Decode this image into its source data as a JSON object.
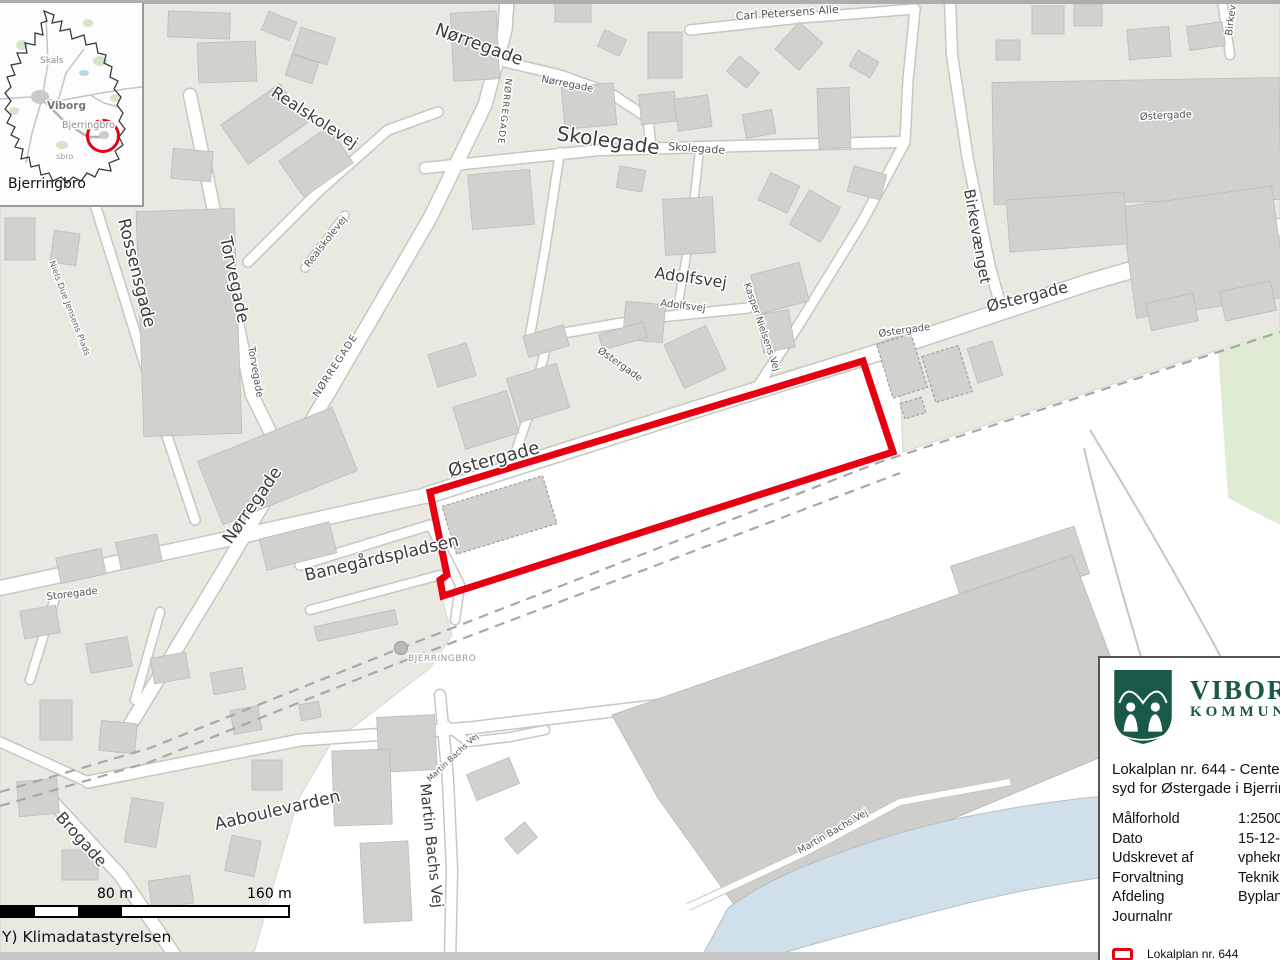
{
  "attribution": "Y) Klimadatastyrelsen",
  "scale_bar": {
    "label_mid": "80 m",
    "label_end": "160 m"
  },
  "inset": {
    "caption": "Bjerringbro",
    "labels": [
      {
        "text": "Skals",
        "x": 40,
        "y": 60,
        "rot": 0,
        "size": 9,
        "color": "#8e8e8e"
      },
      {
        "text": "Viborg",
        "x": 47,
        "y": 106,
        "rot": 0,
        "size": 10.5,
        "color": "#767676",
        "weight": "bold"
      },
      {
        "text": "Bjerringbro",
        "x": 62,
        "y": 125,
        "rot": 0,
        "size": 9.5,
        "color": "#8e8e8e"
      },
      {
        "text": "sbro",
        "x": 56,
        "y": 156,
        "rot": 0,
        "size": 8,
        "color": "#9a9a9a"
      }
    ]
  },
  "map": {
    "labels": [
      {
        "text": "Nørregade",
        "x": 434,
        "y": 34,
        "rot": 20,
        "size": 17.5
      },
      {
        "text": "NØRREGADE",
        "x": 506,
        "y": 78,
        "rot": 97,
        "size": 9,
        "color": "#555555",
        "ls": 1
      },
      {
        "text": "Nørregade",
        "x": 541,
        "y": 82,
        "rot": 11,
        "size": 10,
        "color": "#555555"
      },
      {
        "text": "Carl Petersens Alle",
        "x": 736,
        "y": 20,
        "rot": -4,
        "size": 11,
        "color": "#555555"
      },
      {
        "text": "Skolegade",
        "x": 556,
        "y": 140,
        "rot": 8,
        "size": 20
      },
      {
        "text": "Skolegade",
        "x": 668,
        "y": 150,
        "rot": 4,
        "size": 11,
        "color": "#555555"
      },
      {
        "text": "Realskolevej",
        "x": 270,
        "y": 95,
        "rot": 33,
        "size": 16
      },
      {
        "text": "Realskolevej",
        "x": 309,
        "y": 268,
        "rot": -52,
        "size": 10,
        "color": "#555555"
      },
      {
        "text": "Rossensgade",
        "x": 118,
        "y": 220,
        "rot": 76,
        "size": 17
      },
      {
        "text": "Torvegade",
        "x": 220,
        "y": 238,
        "rot": 78,
        "size": 17
      },
      {
        "text": "Torvegade",
        "x": 248,
        "y": 347,
        "rot": 80,
        "size": 10,
        "color": "#555555"
      },
      {
        "text": "NØRREGADE",
        "x": 318,
        "y": 398,
        "rot": -57,
        "size": 10,
        "color": "#555555",
        "ls": 1
      },
      {
        "text": "Niels Due Jensens Plads",
        "x": 49,
        "y": 262,
        "rot": 69,
        "size": 8.5,
        "color": "#666666"
      },
      {
        "text": "Adolfsvej",
        "x": 654,
        "y": 278,
        "rot": 8,
        "size": 16
      },
      {
        "text": "Adolfsvej",
        "x": 660,
        "y": 306,
        "rot": 7,
        "size": 10,
        "color": "#555555"
      },
      {
        "text": "Kasper Nielsens Vej",
        "x": 744,
        "y": 284,
        "rot": 71,
        "size": 9.5,
        "color": "#555555"
      },
      {
        "text": "Birkevænget",
        "x": 964,
        "y": 190,
        "rot": 80,
        "size": 15
      },
      {
        "text": "Birkev",
        "x": 1232,
        "y": 36,
        "rot": -83,
        "size": 10,
        "color": "#555555"
      },
      {
        "text": "Østergade",
        "x": 879,
        "y": 337,
        "rot": -8,
        "size": 10,
        "color": "#555555"
      },
      {
        "text": "Østergade",
        "x": 988,
        "y": 312,
        "rot": -14,
        "size": 16
      },
      {
        "text": "Østergade",
        "x": 1140,
        "y": 120,
        "rot": -3,
        "size": 10,
        "color": "#555555"
      },
      {
        "text": "Østergade",
        "x": 450,
        "y": 477,
        "rot": -15,
        "size": 18
      },
      {
        "text": "Østergade",
        "x": 597,
        "y": 352,
        "rot": 35,
        "size": 10,
        "color": "#555555"
      },
      {
        "text": "Banegårdspladsen",
        "x": 306,
        "y": 581,
        "rot": -13,
        "size": 17
      },
      {
        "text": "Nørregade",
        "x": 231,
        "y": 545,
        "rot": -55,
        "size": 17
      },
      {
        "text": "Storegade",
        "x": 47,
        "y": 600,
        "rot": -7,
        "size": 10,
        "color": "#555555"
      },
      {
        "text": "BJERRINGBRO",
        "x": 408,
        "y": 661,
        "rot": 0,
        "size": 9,
        "color": "#9a9a9a",
        "ls": 0.5
      },
      {
        "text": "Aaboulevarden",
        "x": 216,
        "y": 830,
        "rot": -13,
        "size": 17
      },
      {
        "text": "Brogade",
        "x": 55,
        "y": 818,
        "rot": 48,
        "size": 16
      },
      {
        "text": "Martin Bachs Vej",
        "x": 420,
        "y": 784,
        "rot": 84,
        "size": 15
      },
      {
        "text": "Martin Bachs Vej",
        "x": 430,
        "y": 782,
        "rot": -43,
        "size": 8,
        "color": "#555555"
      },
      {
        "text": "Martin Bachs Vej",
        "x": 800,
        "y": 854,
        "rot": -30,
        "size": 9.5,
        "color": "#555555"
      }
    ]
  },
  "info_box": {
    "brand_top": "VIBORG",
    "brand_bottom": "KOMMUNE",
    "title_line1": "Lokalplan nr. 644 - Centerområde",
    "title_line2": "syd for Østergade i Bjerringbro",
    "rows": [
      {
        "label": "Målforhold",
        "value": "1:2500"
      },
      {
        "label": "Dato",
        "value": "15-12-2025"
      },
      {
        "label": "Udskrevet af",
        "value": "vphekri"
      },
      {
        "label": "Forvaltning",
        "value": "Teknik & Miljø"
      },
      {
        "label": "Afdeling",
        "value": "Byplan"
      },
      {
        "label": "Journalnr",
        "value": ""
      }
    ],
    "legend_label": "Lokalplan nr. 644"
  },
  "colors": {
    "boundary_red": "#e60012",
    "brand_green": "#1a5848",
    "block": "#e9e8e1",
    "building": "#d2d1cd",
    "river": "#cfe0eb",
    "green_area": "#dfecd3"
  }
}
